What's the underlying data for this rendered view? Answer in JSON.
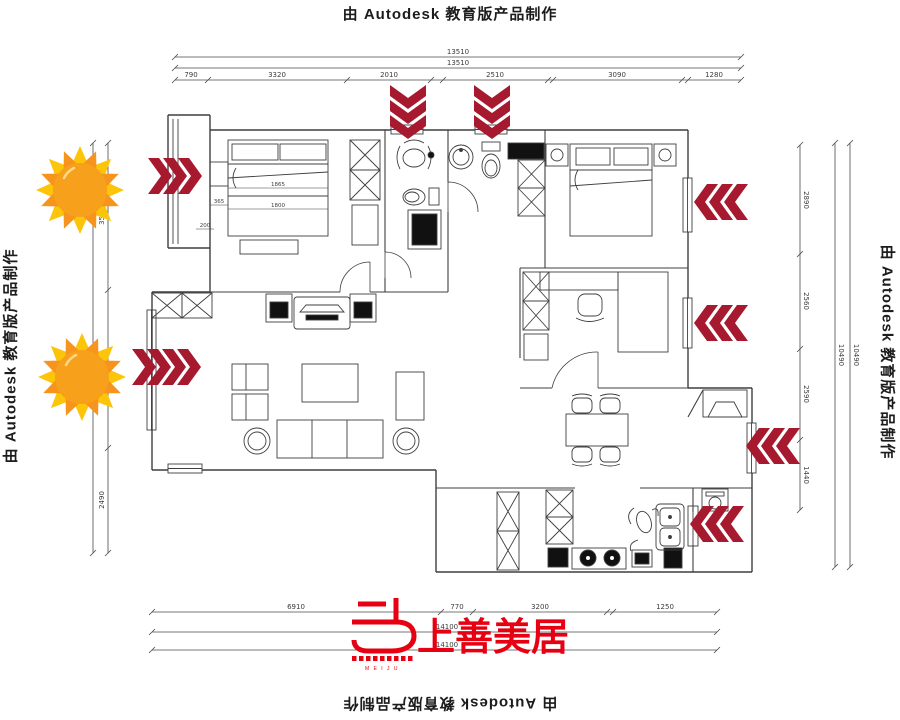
{
  "watermarks": {
    "top": "由 Autodesk 教育版产品制作",
    "left": "由 Autodesk 教育版产品制作",
    "right": "由 Autodesk 教育版产品制作",
    "bottom": "由 Autodesk 教育版产品制作"
  },
  "logo": {
    "name": "上善美居",
    "letters": "M E I J U"
  },
  "dimensions": {
    "top": {
      "overall_a": "13510",
      "overall_b": "13510",
      "segments": [
        "790",
        "3320",
        "2010",
        "2510",
        "3090",
        "1280"
      ]
    },
    "bottom": {
      "segments": [
        "6910",
        "770",
        "3200",
        "1250"
      ],
      "overall_a": "14100",
      "overall_b": "14100"
    },
    "left": {
      "segments": [
        "3500",
        "2490"
      ]
    },
    "right": {
      "segments": [
        "2890",
        "2560",
        "2590",
        "1440"
      ],
      "overall_a": "10490",
      "overall_b": "10490"
    }
  },
  "plan_labels": {
    "bed_width": "1865",
    "bed_length": "1800",
    "offset_a": "365",
    "offset_b": "200"
  },
  "colors": {
    "arrow": "#A6192E",
    "logo_red": "#E60012",
    "sun_body": "#F7A01B",
    "sun_ray_light": "#FDC50A",
    "sun_ray_dark": "#F7941D",
    "line": "#3f3f3f",
    "dim_text": "#3c3c3c"
  }
}
